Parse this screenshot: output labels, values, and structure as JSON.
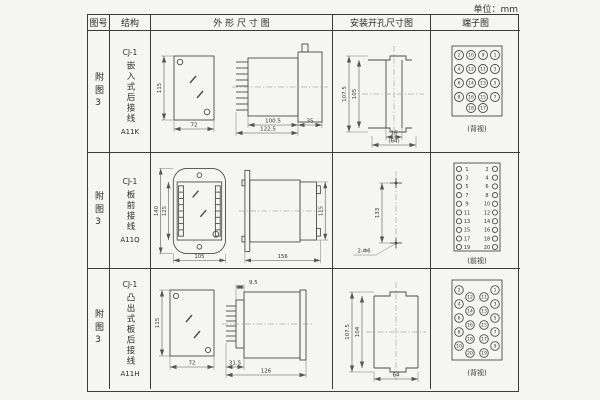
{
  "unit_label": "单位：mm",
  "header": {
    "fig": "图号",
    "structure": "结构",
    "outline": "外 形 尺 寸 图",
    "mounting": "安装开孔尺寸图",
    "terminal": "端子图"
  },
  "rows": [
    {
      "fig": "附图3",
      "code": "CJ-1",
      "style": "嵌入式后接线",
      "model": "A11K",
      "outline": {
        "front_h": "115",
        "front_w": "72",
        "body_len": "100.5",
        "total_len": "122.5",
        "flange_w": "35"
      },
      "mounting": {
        "outer_h": "107.5",
        "inner_h": "105",
        "slot_w": "16",
        "span_w": "(64)"
      },
      "terminal": {
        "view": "(背视)",
        "grid": [
          [
            "2",
            "10",
            "9",
            "1"
          ],
          [
            "4",
            "12",
            "11",
            "3"
          ],
          [
            "6",
            "14",
            "13",
            "5"
          ],
          [
            "8",
            "16",
            "15",
            "7"
          ],
          [
            "18",
            "17"
          ]
        ]
      }
    },
    {
      "fig": "附图3",
      "code": "CJ-1",
      "style": "板前接线",
      "model": "A11Q",
      "outline": {
        "outer_h": "140",
        "inner_h": "125",
        "front_w": "105",
        "total_len": "156",
        "side_h": "115"
      },
      "mounting": {
        "hole_dist": "133",
        "holes": "2-Φ6"
      },
      "terminal": {
        "view": "(前视)",
        "pairs": [
          [
            "1",
            "2"
          ],
          [
            "3",
            "4"
          ],
          [
            "5",
            "6"
          ],
          [
            "7",
            "8"
          ],
          [
            "9",
            "10"
          ],
          [
            "11",
            "12"
          ],
          [
            "13",
            "14"
          ],
          [
            "15",
            "16"
          ],
          [
            "17",
            "18"
          ],
          [
            "19",
            "20"
          ]
        ]
      }
    },
    {
      "fig": "附图3",
      "code": "CJ-1",
      "style": "凸出式板后接线",
      "model": "A11H",
      "outline": {
        "front_h": "115",
        "front_w": "72",
        "pin_len": "31.5",
        "step": "9.5",
        "total_len": "126"
      },
      "mounting": {
        "outer_h": "107.5",
        "inner_h": "104",
        "width": "64"
      },
      "terminal": {
        "view": "(背视)",
        "grid": [
          [
            "2",
            "12",
            "11",
            "1"
          ],
          [
            "4",
            "14",
            "13",
            "3"
          ],
          [
            "6",
            "16",
            "15",
            "5"
          ],
          [
            "8",
            "18",
            "17",
            "7"
          ],
          [
            "10",
            "20",
            "19",
            "9"
          ]
        ]
      }
    }
  ]
}
